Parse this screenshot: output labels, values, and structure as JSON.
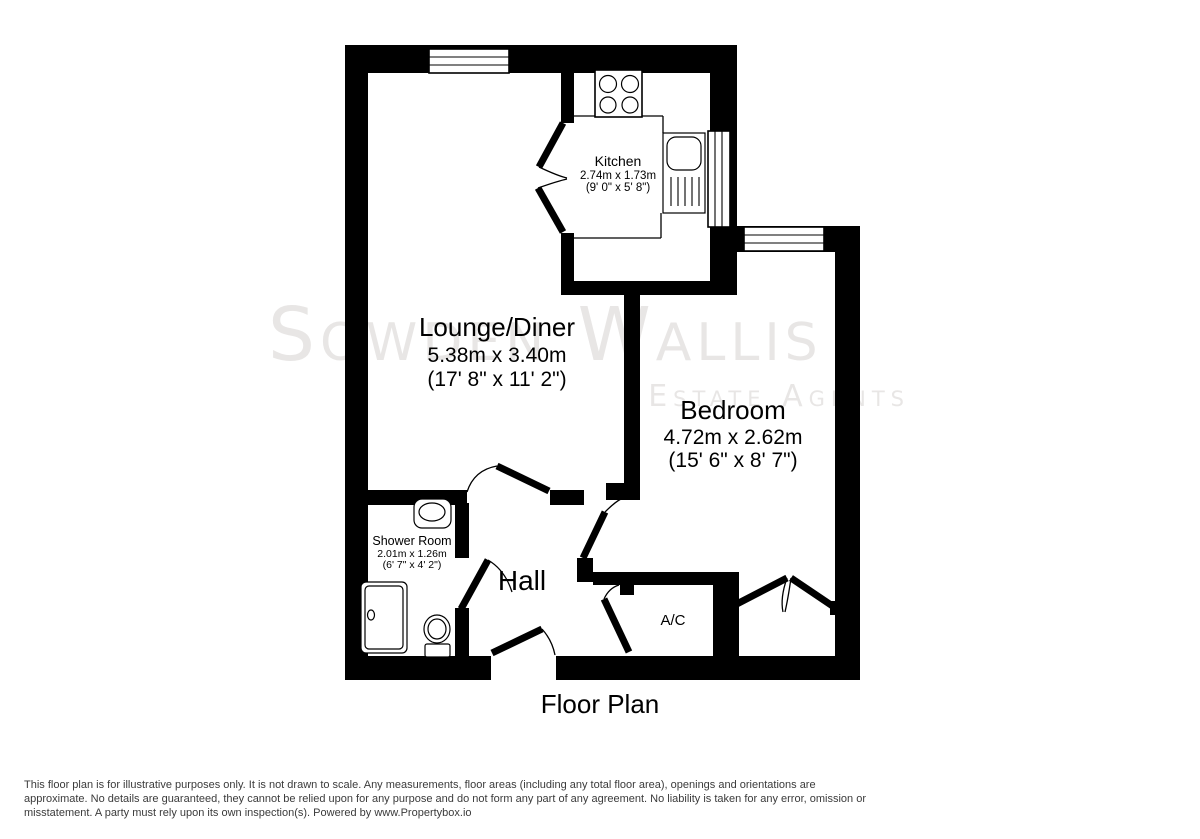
{
  "title": "Floor Plan",
  "watermark": {
    "line1": "Sowden Wallis",
    "line2": "Estate Agents"
  },
  "rooms": {
    "kitchen": {
      "name": "Kitchen",
      "metric": "2.74m x 1.73m",
      "imperial": "(9' 0\" x 5' 8\")"
    },
    "lounge": {
      "name": "Lounge/Diner",
      "metric": "5.38m x 3.40m",
      "imperial": "(17' 8\" x 11' 2\")"
    },
    "bedroom": {
      "name": "Bedroom",
      "metric": "4.72m x 2.62m",
      "imperial": "(15' 6\" x 8' 7\")"
    },
    "shower": {
      "name": "Shower Room",
      "metric": "2.01m x 1.26m",
      "imperial": "(6' 7\" x 4' 2\")"
    },
    "hall": {
      "name": "Hall"
    },
    "ac": {
      "name": "A/C"
    }
  },
  "disclaimer": {
    "line1": "This floor plan is for illustrative purposes only. It is not drawn to scale. Any measurements, floor areas (including any total floor area), openings and orientations are",
    "line2": "approximate. No details are guaranteed, they cannot be relied upon for any purpose and do not form any part of any agreement. No liability is taken for any error, omission or",
    "line3": "misstatement. A party must rely upon its own inspection(s). Powered by www.Propertybox.io"
  },
  "colors": {
    "wall": "#000000",
    "background": "#ffffff",
    "watermark": "#e8e6e5",
    "label_text": "#000000",
    "disclaimer_text": "#3b3b3b"
  }
}
